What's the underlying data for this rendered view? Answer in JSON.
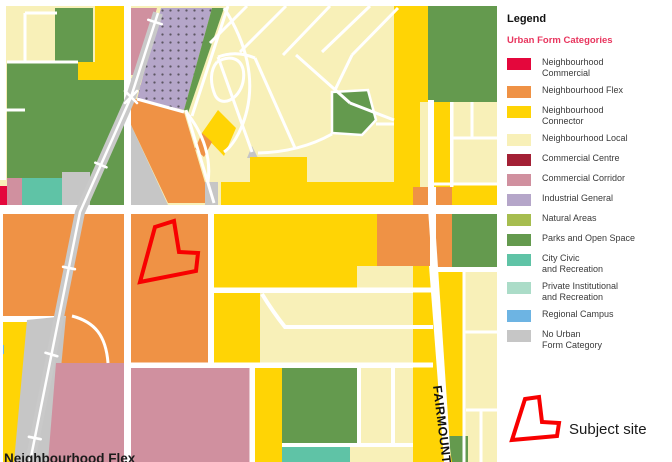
{
  "colors": {
    "commercial": "#e4073c",
    "flex": "#ef9245",
    "connector": "#ffd405",
    "local": "#f8f0b8",
    "centre": "#a32035",
    "corridor": "#d0909f",
    "industrial": "#b5a6c9",
    "natural": "#a6bd4f",
    "parks": "#649a4e",
    "civic": "#5fc3a6",
    "private": "#abdcc8",
    "campus": "#6db4e3",
    "none": "#c6c6c6",
    "site": "#f80000",
    "subtitle": "#e8355e"
  },
  "map": {
    "street_label": "FAIRMOUNT",
    "caption": "Neighbourhood Flex"
  },
  "legend": {
    "title": "Legend",
    "subtitle": "Urban Form Categories",
    "items": [
      {
        "line1": "Neighbourhood",
        "line2": "Commercial",
        "category": "commercial"
      },
      {
        "line1": "Neighbourhood Flex",
        "line2": "",
        "category": "flex"
      },
      {
        "line1": "Neighbourhood",
        "line2": "Connector",
        "category": "connector"
      },
      {
        "line1": "Neighbourhood Local",
        "line2": "",
        "category": "local"
      },
      {
        "line1": "Commercial Centre",
        "line2": "",
        "category": "centre"
      },
      {
        "line1": "Commercial Corridor",
        "line2": "",
        "category": "corridor"
      },
      {
        "line1": "Industrial General",
        "line2": "",
        "category": "industrial"
      },
      {
        "line1": "Natural Areas",
        "line2": "",
        "category": "natural"
      },
      {
        "line1": "Parks and Open Space",
        "line2": "",
        "category": "parks"
      },
      {
        "line1": "City Civic",
        "line2": "and Recreation",
        "category": "civic"
      },
      {
        "line1": "Private Institutional",
        "line2": "and Recreation",
        "category": "private"
      },
      {
        "line1": "Regional Campus",
        "line2": "",
        "category": "campus"
      },
      {
        "line1": "No Urban",
        "line2": "Form Category",
        "category": "none"
      }
    ],
    "subject_site_label": "Subject site"
  }
}
